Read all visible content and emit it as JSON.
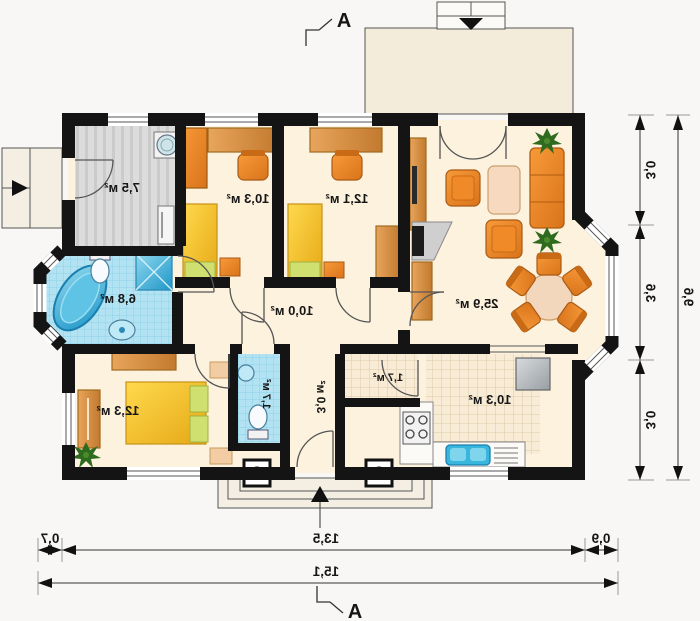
{
  "plan": {
    "section_marker": {
      "top": "A",
      "bottom": "A"
    },
    "rooms": {
      "vestibule": "7,5 м²",
      "bedroom_1": "10,3 м²",
      "bedroom_2": "12,1 м²",
      "living_room": "25,9 м²",
      "bathroom": "6,8 м²",
      "corridor": "10,0 м²",
      "bedroom_3": "12,3 м²",
      "wc": "1,7 м²",
      "hall": "3,0 м²",
      "pantry": "1,7 м²",
      "kitchen": "10,3 м²"
    },
    "dimensions": {
      "right_segments": [
        "3,0",
        "3,6",
        "3,0"
      ],
      "right_total": "9,6",
      "bottom_segments": [
        "0,7",
        "13,5",
        "0,9"
      ],
      "bottom_total": "15,1"
    },
    "colors": {
      "wall": "#141414",
      "floor": "#fdf2de",
      "terrace": "#f4ecda",
      "tile_blue": "#b3e3f2",
      "tile_cream": "#f8ecd6",
      "stripe_gray": "#dcdcdc",
      "furniture_orange": "#ee8a28",
      "wood": "#d8913f",
      "bed_yellow": "#f4c433",
      "accent_green": "#cfe070",
      "plant_green": "#2f6b1f"
    }
  }
}
